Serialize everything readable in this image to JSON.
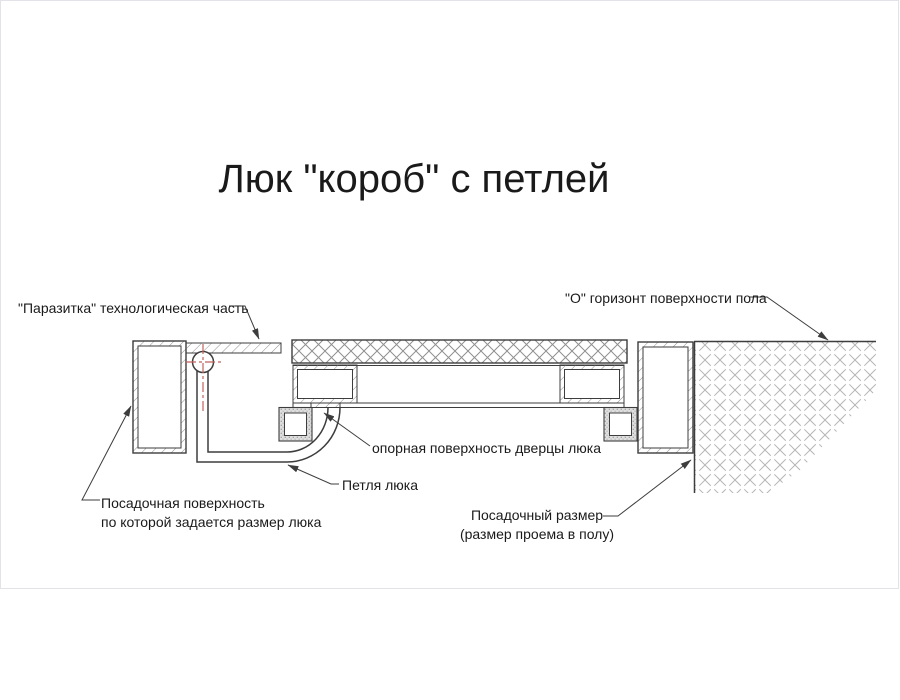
{
  "title": "Люк \"короб\" с петлей",
  "labels": {
    "parasitka": "\"Паразитка\" технологическая часть",
    "o_horizon": "\"О\" горизонт поверхности пола",
    "opornaya": "опорная поверхность дверцы люка",
    "petlya": "Петля люка",
    "posadochnaya_line1": "Посадочная поверхность",
    "posadochnaya_line2": "по которой задается размер люка",
    "posadochny_line1": "Посадочный размер",
    "posadochny_line2": "(размер проема в полу)"
  },
  "colors": {
    "line": "#3d3d3d",
    "hatch": "#8f8f8f",
    "centerline": "#c4615c",
    "background": "#ffffff",
    "text": "#1a1a1a"
  }
}
